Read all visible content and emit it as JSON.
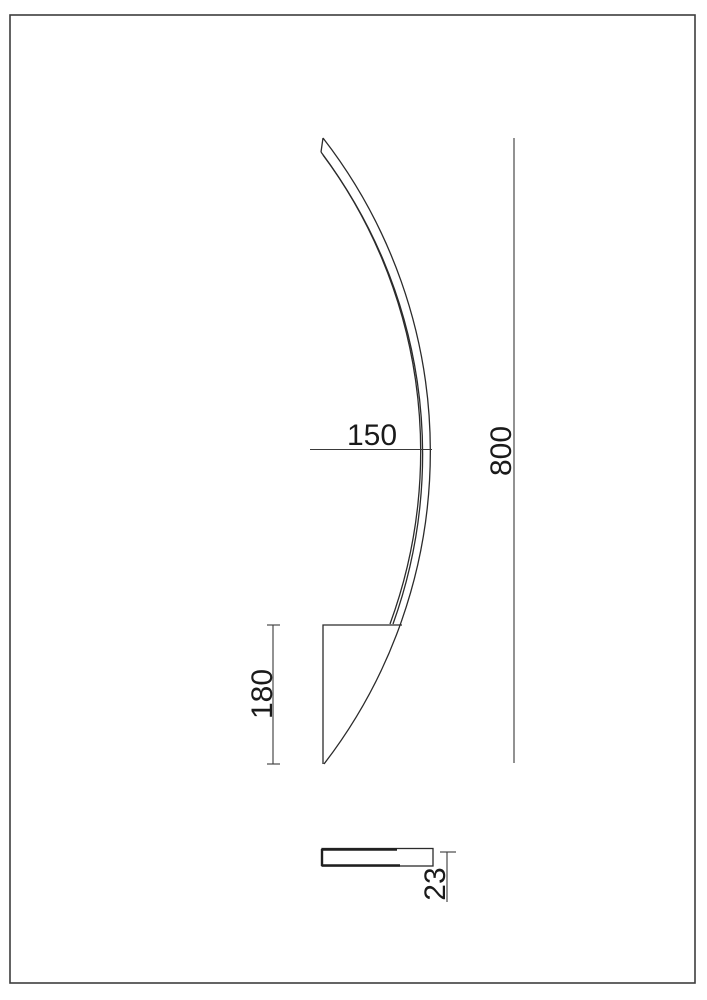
{
  "sheet": {
    "background_color": "#ffffff",
    "border_color": "#3d3d3d",
    "line_color": "#2b2b2b"
  },
  "dimensions": {
    "projection_depth": {
      "value": "150"
    },
    "overall_height": {
      "value": "800"
    },
    "bracket_height": {
      "value": "180"
    },
    "thickness": {
      "value": "23"
    }
  }
}
